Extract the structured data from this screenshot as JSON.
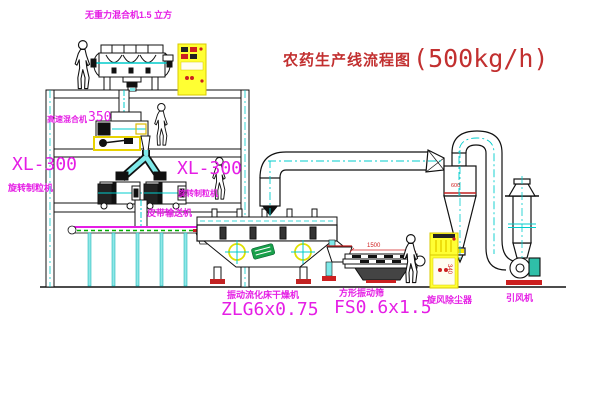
{
  "title": {
    "name": "农药生产线流程图",
    "capacity": "(500kg/h)"
  },
  "labels": {
    "gravity_mixer": "无重力混合机1.5 立方",
    "high_speed_mixer_name": "高速混合机",
    "high_speed_mixer_size": "350",
    "granulator_left_model": "XL-300",
    "granulator_left_name": "旋转制粒机",
    "granulator_right_model": "XL-300",
    "granulator_right_name": "旋转制粒机",
    "belt_conveyor": "皮带输送机",
    "dryer_name": "振动流化床干燥机",
    "dryer_model": "ZLG6x0.75",
    "sieve_name": "方形振动筛",
    "sieve_model": "FS0.6x1.5",
    "cyclone_name": "旋风除尘器",
    "fan_name": "引风机"
  },
  "dimensions": {
    "sieve_length": "1500",
    "sieve_height": "340",
    "cyclone_marking": "600"
  },
  "colors": {
    "label_magenta": "#e51ee5",
    "title_red": "#c23030",
    "dimension_red": "#d02020",
    "line_black": "#111111",
    "accent_cyan": "#00cccc",
    "highlight_yellow": "#ffff33",
    "machine_green": "#18a04a"
  }
}
